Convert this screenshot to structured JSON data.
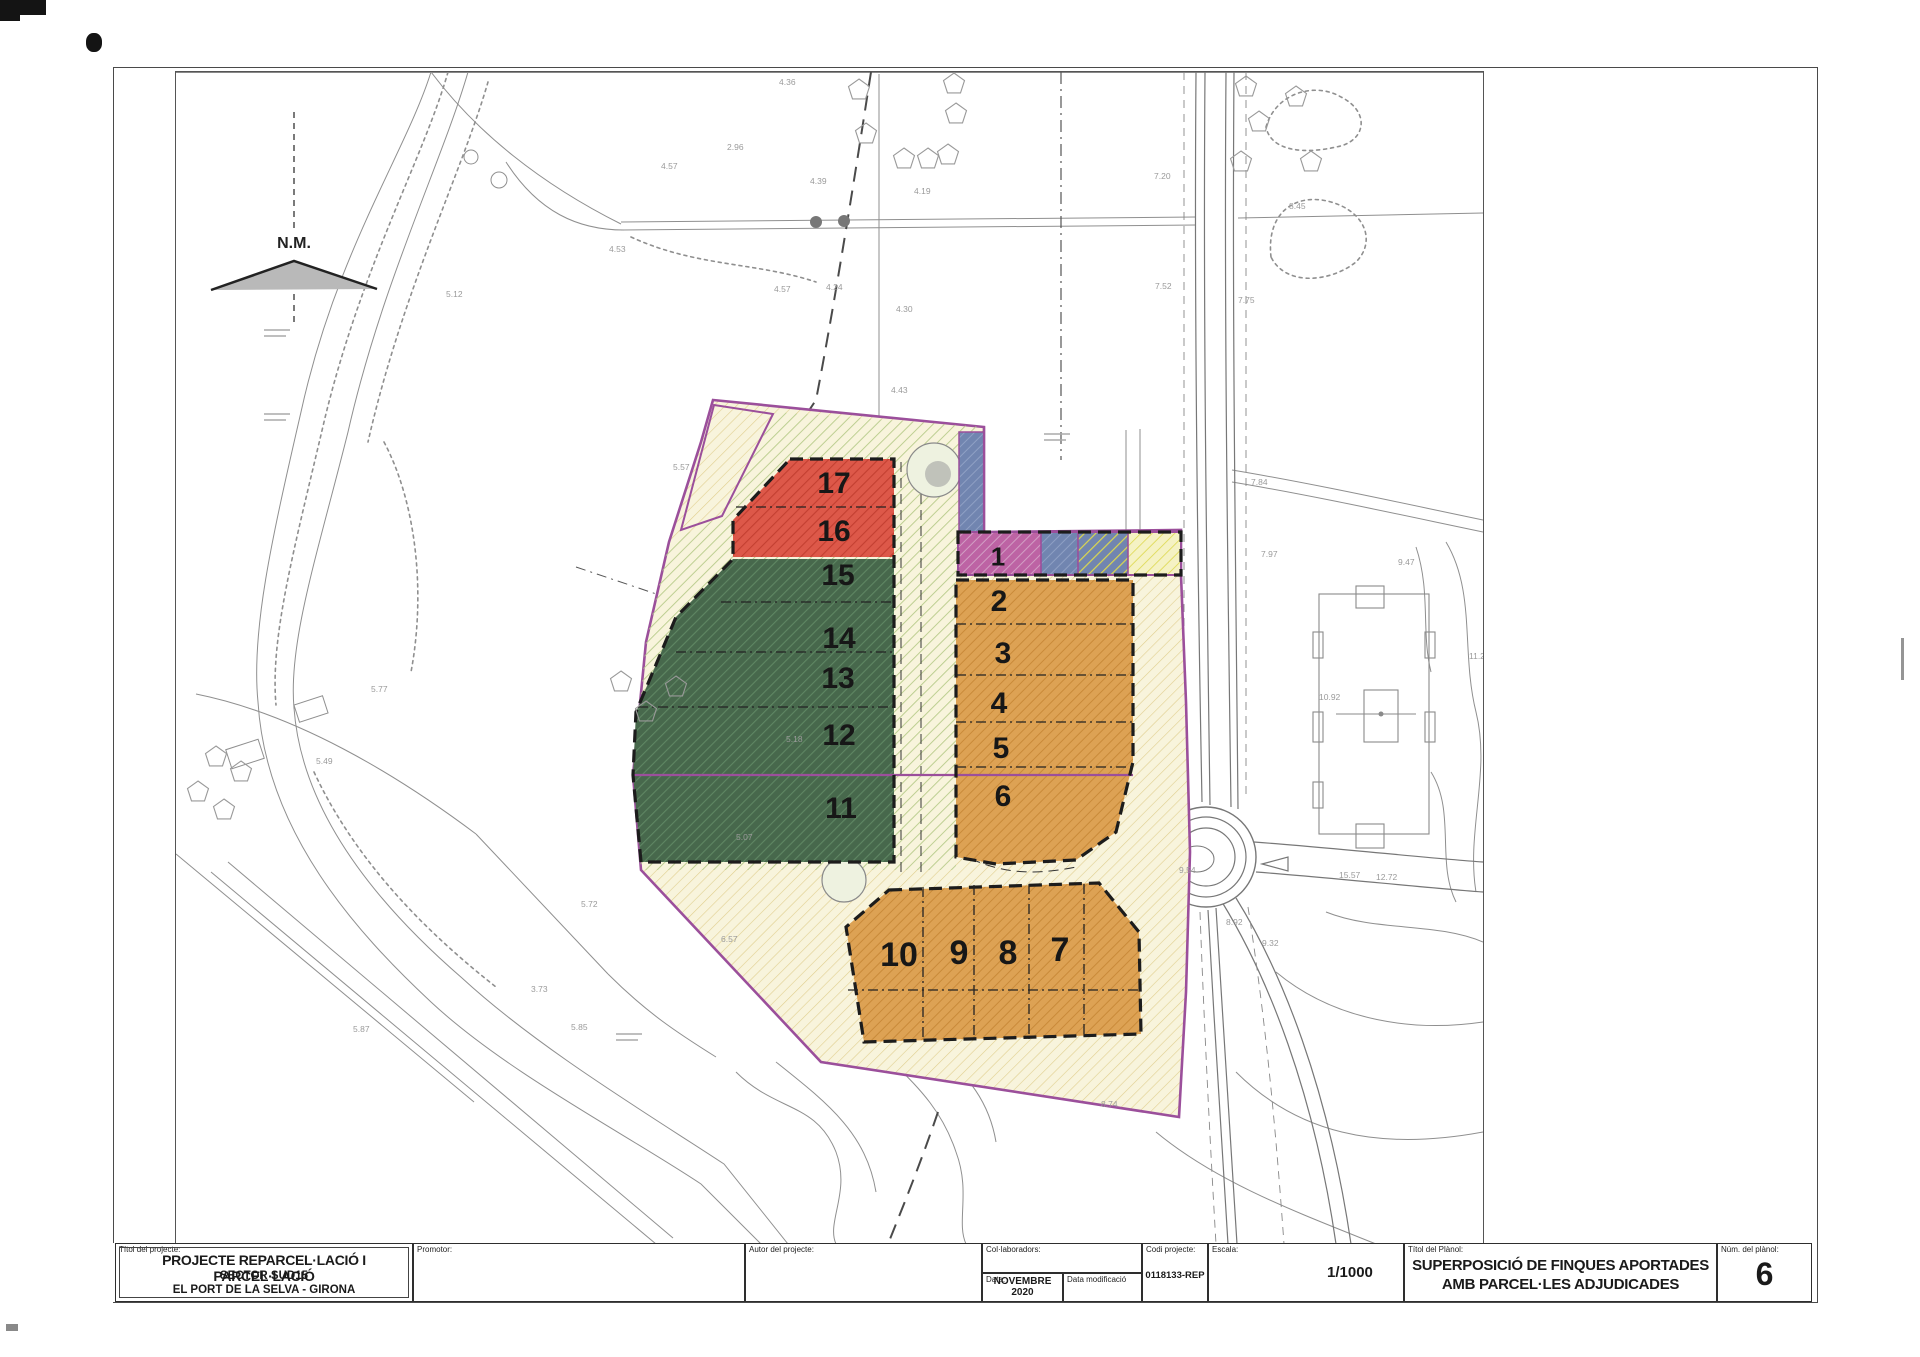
{
  "north_marker": {
    "label": "N.M."
  },
  "title_block": {
    "project_label": "Títol del projecte:",
    "project_title": "PROJECTE REPARCEL·LACIÓ I PARCEL·LACIÓ",
    "project_subtitle1": "SECTOR SUD15",
    "project_subtitle2": "EL PORT DE LA SELVA - GIRONA",
    "promotor_label": "Promotor:",
    "autor_label": "Autor del projecte:",
    "colaboradors_label": "Col·laboradors:",
    "data_label": "Data:",
    "data_value": "NOVEMBRE 2020",
    "data_mod_label": "Data modificació",
    "codi_label": "Codi projecte:",
    "codi_value": "0118133-REP",
    "escala_label": "Escala:",
    "escala_value": "1/1000",
    "planol_label": "Títol del Plànol:",
    "planol_title1": "SUPERPOSICIÓ DE FINQUES APORTADES",
    "planol_title2": "AMB PARCEL·LES ADJUDICADES",
    "num_label": "Núm. del plànol:",
    "num_value": "6"
  },
  "map": {
    "colors": {
      "sector_boundary": "#9b4f9b",
      "cream_bg": "#f8f4dc",
      "cream_hatch": "#e0cf8f",
      "lightgreen_hatch": "#b4cd8e",
      "red_fill": "#dd5849",
      "red_hatch": "#c33f31",
      "green_fill": "#47684c",
      "green_hatch": "#5f8763",
      "orange_fill": "#dda254",
      "orange_hatch": "#c98a39",
      "magenta_fill": "#bd63a4",
      "magenta_hatch": "#d29ec4",
      "blue_fill": "#7185b0",
      "blue_hatch": "#8fa0c4",
      "yellow_hatch": "#ddd84e",
      "paleyellow_fill": "#f5f2c4",
      "base_line": "#8f8f8f",
      "dash_black": "#1c1c1c"
    },
    "parcel_labels": [
      {
        "n": "1",
        "x": 822,
        "y": 484,
        "s": 26
      },
      {
        "n": "2",
        "x": 823,
        "y": 528,
        "s": 30
      },
      {
        "n": "3",
        "x": 827,
        "y": 580,
        "s": 30
      },
      {
        "n": "4",
        "x": 823,
        "y": 630,
        "s": 30
      },
      {
        "n": "5",
        "x": 825,
        "y": 675,
        "s": 30
      },
      {
        "n": "6",
        "x": 827,
        "y": 723,
        "s": 30
      },
      {
        "n": "7",
        "x": 884,
        "y": 877,
        "s": 34
      },
      {
        "n": "8",
        "x": 832,
        "y": 880,
        "s": 34
      },
      {
        "n": "9",
        "x": 783,
        "y": 880,
        "s": 34
      },
      {
        "n": "10",
        "x": 723,
        "y": 882,
        "s": 34
      },
      {
        "n": "11",
        "x": 665,
        "y": 735,
        "s": 30
      },
      {
        "n": "12",
        "x": 663,
        "y": 662,
        "s": 30
      },
      {
        "n": "13",
        "x": 662,
        "y": 605,
        "s": 30
      },
      {
        "n": "14",
        "x": 663,
        "y": 565,
        "s": 30
      },
      {
        "n": "15",
        "x": 662,
        "y": 502,
        "s": 30
      },
      {
        "n": "16",
        "x": 658,
        "y": 458,
        "s": 30
      },
      {
        "n": "17",
        "x": 658,
        "y": 410,
        "s": 30
      }
    ],
    "elevation_labels": [
      {
        "v": "4.36",
        "x": 603,
        "y": 13
      },
      {
        "v": "2.96",
        "x": 551,
        "y": 78
      },
      {
        "v": "4.57",
        "x": 485,
        "y": 97
      },
      {
        "v": "4.53",
        "x": 433,
        "y": 180
      },
      {
        "v": "4.39",
        "x": 634,
        "y": 112
      },
      {
        "v": "4.19",
        "x": 738,
        "y": 122
      },
      {
        "v": "4.43",
        "x": 715,
        "y": 321
      },
      {
        "v": "4.57",
        "x": 598,
        "y": 220
      },
      {
        "v": "4.24",
        "x": 650,
        "y": 218
      },
      {
        "v": "4.30",
        "x": 720,
        "y": 240
      },
      {
        "v": "5.12",
        "x": 270,
        "y": 225
      },
      {
        "v": "5.57",
        "x": 497,
        "y": 398
      },
      {
        "v": "7.20",
        "x": 978,
        "y": 107
      },
      {
        "v": "8.45",
        "x": 1113,
        "y": 137
      },
      {
        "v": "7.52",
        "x": 979,
        "y": 217
      },
      {
        "v": "7.75",
        "x": 1062,
        "y": 231
      },
      {
        "v": "7.84",
        "x": 1075,
        "y": 413
      },
      {
        "v": "7.97",
        "x": 1085,
        "y": 485
      },
      {
        "v": "9.47",
        "x": 1222,
        "y": 493
      },
      {
        "v": "11.27",
        "x": 1293,
        "y": 587
      },
      {
        "v": "10.92",
        "x": 1143,
        "y": 628
      },
      {
        "v": "9.54",
        "x": 1003,
        "y": 801
      },
      {
        "v": "15.57",
        "x": 1163,
        "y": 806
      },
      {
        "v": "12.72",
        "x": 1200,
        "y": 808
      },
      {
        "v": "8.92",
        "x": 1050,
        "y": 853
      },
      {
        "v": "9.32",
        "x": 1086,
        "y": 874
      },
      {
        "v": "5.49",
        "x": 140,
        "y": 692
      },
      {
        "v": "5.18",
        "x": 610,
        "y": 670
      },
      {
        "v": "5.77",
        "x": 195,
        "y": 620
      },
      {
        "v": "5.07",
        "x": 560,
        "y": 768
      },
      {
        "v": "5.72",
        "x": 405,
        "y": 835
      },
      {
        "v": "3.73",
        "x": 355,
        "y": 920
      },
      {
        "v": "5.87",
        "x": 177,
        "y": 960
      },
      {
        "v": "5.85",
        "x": 395,
        "y": 958
      },
      {
        "v": "8.74",
        "x": 925,
        "y": 1035
      },
      {
        "v": "6.57",
        "x": 545,
        "y": 870
      }
    ]
  }
}
